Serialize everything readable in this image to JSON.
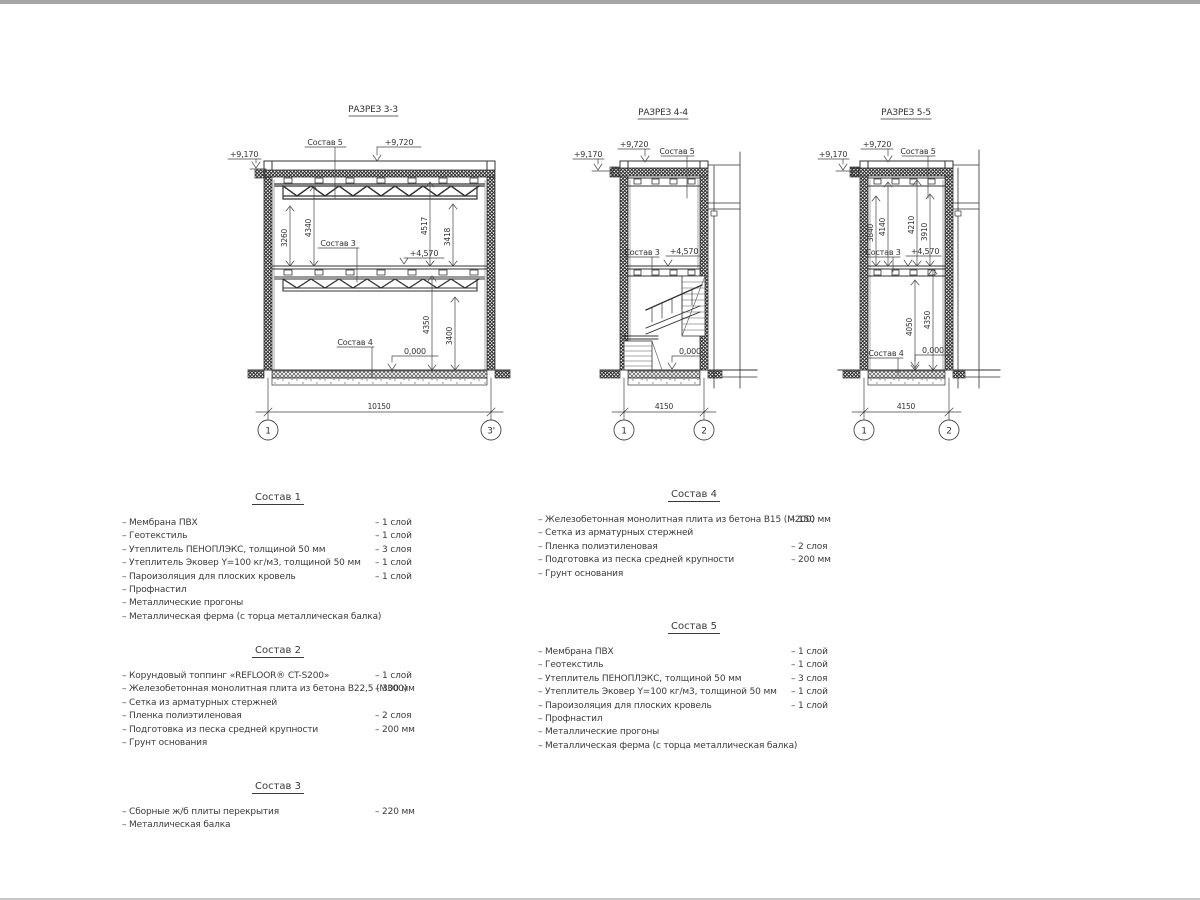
{
  "page": {
    "background": "#ffffff",
    "line_color": "#333333",
    "top_edge_color": "#a5a5a5",
    "bottom_edge_color": "#c9c9c9"
  },
  "sections": {
    "s33": {
      "title": "РАЗРЕЗ 3-3",
      "levels": {
        "eave": "+9,170",
        "parapet": "+9,720",
        "mid": "+4,570",
        "zero": "0,000"
      },
      "comps": {
        "roof": "Состав 5",
        "mid": "Состав 3",
        "floor": "Состав 4"
      },
      "dims_upper": [
        "3260",
        "4340",
        "4517",
        "3418"
      ],
      "dims_lower": [
        "4350",
        "3400"
      ],
      "span": "10150",
      "axes": [
        "1",
        "3'"
      ]
    },
    "s44": {
      "title": "РАЗРЕЗ 4-4",
      "levels": {
        "eave": "+9,170",
        "parapet": "+9,720",
        "mid": "+4,570",
        "zero": "0,000"
      },
      "comps": {
        "roof": "Состав 5",
        "mid": "Состав 3"
      },
      "span": "4150",
      "axes": [
        "1",
        "2"
      ]
    },
    "s55": {
      "title": "РАЗРЕЗ 5-5",
      "levels": {
        "eave": "+9,170",
        "parapet": "+9,720",
        "mid": "+4,570",
        "zero": "0,000"
      },
      "comps": {
        "roof": "Состав 5",
        "mid": "Состав 3",
        "floor": "Состав 4"
      },
      "dims_upper": [
        "3840",
        "4140",
        "4210",
        "3910"
      ],
      "dims_lower": [
        "4050",
        "4350"
      ],
      "span": "4150",
      "axes": [
        "1",
        "2"
      ]
    }
  },
  "specs": [
    {
      "title": "Состав 1",
      "items": [
        {
          "name": "Мембрана ПВХ",
          "value": "1 слой"
        },
        {
          "name": "Геотекстиль",
          "value": "1 слой"
        },
        {
          "name": "Утеплитель ПЕНОПЛЭКС, толщиной 50 мм",
          "value": "3 слоя"
        },
        {
          "name": "Утеплитель Эковер Y=100 кг/м3, толщиной 50 мм",
          "value": "1 слой"
        },
        {
          "name": "Пароизоляция для плоских кровель",
          "value": "1 слой"
        },
        {
          "name": "Профнастил",
          "value": ""
        },
        {
          "name": "Металлические прогоны",
          "value": ""
        },
        {
          "name": "Металлическая ферма (с торца металлическая балка)",
          "value": ""
        }
      ]
    },
    {
      "title": "Состав 2",
      "items": [
        {
          "name": "Корундовый топпинг «REFLOOR® CT-S200»",
          "value": "1 слой"
        },
        {
          "name": "Железобетонная  монолитная плита из бетона В22,5 (М300)",
          "value": "300 мм"
        },
        {
          "name": "Сетка из арматурных стержней",
          "value": ""
        },
        {
          "name": "Пленка полиэтиленовая",
          "value": "2 слоя"
        },
        {
          "name": "Подготовка из песка средней крупности",
          "value": "200 мм"
        },
        {
          "name": "Грунт основания",
          "value": ""
        }
      ]
    },
    {
      "title": "Состав 3",
      "items": [
        {
          "name": "Сборные ж/б плиты перекрытия",
          "value": "220 мм"
        },
        {
          "name": "Металлическая балка",
          "value": ""
        }
      ]
    },
    {
      "title": "Состав 4",
      "items": [
        {
          "name": "Железобетонная  монолитная плита из бетона В15 (М200)",
          "value": "150 мм"
        },
        {
          "name": "Сетка из арматурных стержней",
          "value": ""
        },
        {
          "name": "Пленка полиэтиленовая",
          "value": "2 слоя"
        },
        {
          "name": "Подготовка из песка средней крупности",
          "value": "200 мм"
        },
        {
          "name": "Грунт основания",
          "value": ""
        }
      ]
    },
    {
      "title": "Состав 5",
      "items": [
        {
          "name": "Мембрана ПВХ",
          "value": "1 слой"
        },
        {
          "name": "Геотекстиль",
          "value": "1 слой"
        },
        {
          "name": "Утеплитель ПЕНОПЛЭКС, толщиной 50 мм",
          "value": "3 слоя"
        },
        {
          "name": "Утеплитель Эковер Y=100 кг/м3, толщиной 50 мм",
          "value": "1 слой"
        },
        {
          "name": "Пароизоляция для плоских кровель",
          "value": "1 слой"
        },
        {
          "name": "Профнастил",
          "value": ""
        },
        {
          "name": "Металлические прогоны",
          "value": ""
        },
        {
          "name": "Металлическая ферма (с торца металлическая балка)",
          "value": ""
        }
      ]
    }
  ]
}
